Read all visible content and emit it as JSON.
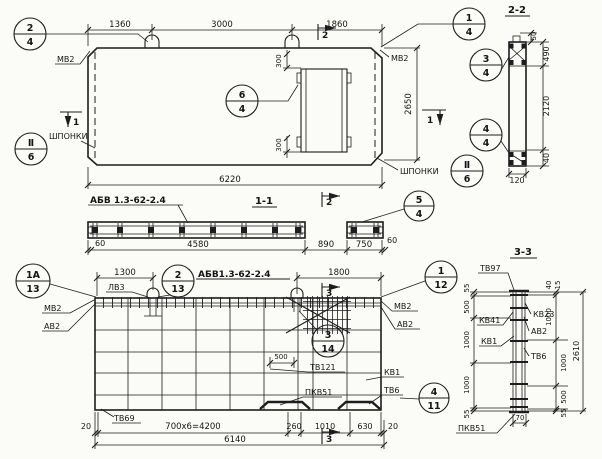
{
  "colors": {
    "ink": "#1d1d1d",
    "paper": "#fbfbf8"
  },
  "plan": {
    "dims": {
      "w1": "1360",
      "w2": "3000",
      "w3": "1860",
      "total": "6220",
      "height": "2650",
      "o300t": "300",
      "o300b": "300"
    },
    "cuts": {
      "c2": "2",
      "c1": "1"
    },
    "labels": {
      "mv2_left": "МВ2",
      "mv2_right": "МВ2",
      "shponki_left": "ШПОНКИ",
      "shponki_right": "ШПОНКИ"
    },
    "callouts": {
      "c24": {
        "n": "2",
        "d": "4"
      },
      "c64": {
        "n": "6",
        "d": "4"
      },
      "c14": {
        "n": "1",
        "d": "4"
      },
      "c34": {
        "n": "3",
        "d": "4"
      },
      "c44": {
        "n": "4",
        "d": "4"
      },
      "sh_l": {
        "n": "Ⅱ",
        "d": "6"
      },
      "sh_r": {
        "n": "Ⅱ",
        "d": "6"
      }
    }
  },
  "section_1_1": {
    "title": "1-1",
    "mark": "АБВ 1.3-62-2.4",
    "dims": [
      "60",
      "4580",
      "890",
      "750",
      "60"
    ],
    "callout": {
      "n": "5",
      "d": "4"
    }
  },
  "section_2_2": {
    "title": "2-2",
    "dims": {
      "d50": "50",
      "d490": "490",
      "d2120": "2120",
      "d40": "40",
      "w": "120"
    }
  },
  "elevation": {
    "title": "АБВ1.3-62-2.4",
    "cut": "3",
    "callouts": {
      "c1a13": {
        "n": "1А",
        "d": "13"
      },
      "c213": {
        "n": "2",
        "d": "13"
      },
      "c112": {
        "n": "1",
        "d": "12"
      },
      "c314": {
        "n": "3",
        "d": "14"
      },
      "c411": {
        "n": "4",
        "d": "11"
      }
    },
    "labels": {
      "mv2_left": "МВ2",
      "av2_left": "АВ2",
      "lv3": "ЛВ3",
      "mv2_right": "МВ2",
      "av2_right": "АВ2",
      "tv121": "ТВ121",
      "kv1": "КВ1",
      "pkv51": "ПКВ51",
      "tv6": "ТВ6",
      "tv69": "ТВ69"
    },
    "dims": {
      "t1300": "1300",
      "t1800": "1800",
      "i500": "500",
      "b20l": "20",
      "bmain": "700x6=4200",
      "b260": "260",
      "b1010": "1010",
      "b630": "630",
      "b20r": "20",
      "total": "6140"
    }
  },
  "section_3_3": {
    "title": "3-3",
    "labels": {
      "tv97": "ТВ97",
      "kv41": "КВ41",
      "kv1": "КВ1",
      "kv23": "КВ23",
      "av2": "АВ2",
      "tv6": "ТВ6",
      "pkv51": "ПКВ51"
    },
    "dims_left": [
      "55",
      "500",
      "1000",
      "1000",
      "55"
    ],
    "dims_right": [
      "40",
      "15",
      "1000",
      "1000",
      "500",
      "55"
    ],
    "total": "2610",
    "w70": "70"
  }
}
